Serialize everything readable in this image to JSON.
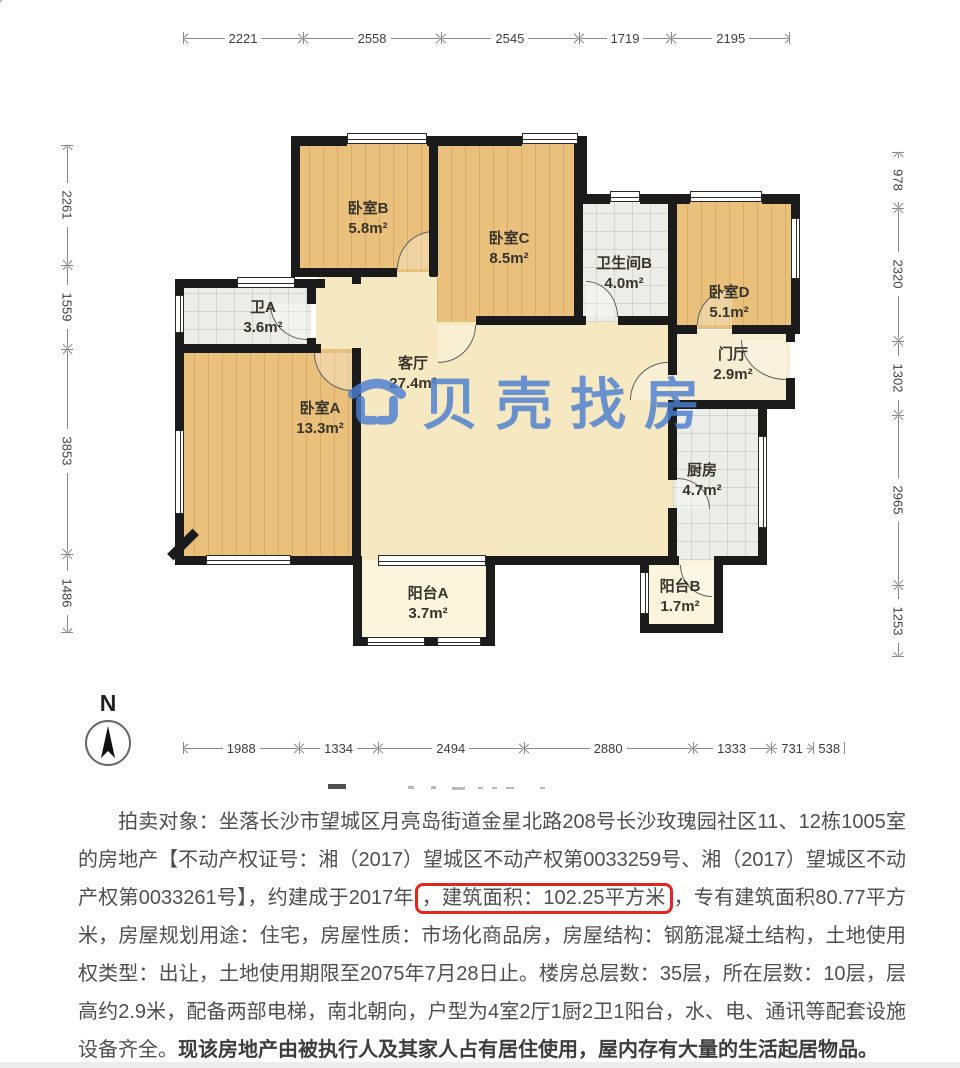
{
  "figure": {
    "watermark_text": "贝壳找房",
    "north_label": "N",
    "rooms": [
      {
        "id": "bedroomB",
        "name": "卧室B",
        "area": "5.8m²"
      },
      {
        "id": "bedroomC",
        "name": "卧室C",
        "area": "8.5m²"
      },
      {
        "id": "bathB",
        "name": "卫生间B",
        "area": "4.0m²"
      },
      {
        "id": "bedroomD",
        "name": "卧室D",
        "area": "5.1m²"
      },
      {
        "id": "bathA",
        "name": "卫A",
        "area": "3.6m²"
      },
      {
        "id": "living",
        "name": "客厅",
        "area": "27.4m²"
      },
      {
        "id": "hall",
        "name": "门厅",
        "area": "2.9m²"
      },
      {
        "id": "bedroomA",
        "name": "卧室A",
        "area": "13.3m²"
      },
      {
        "id": "kitchen",
        "name": "厨房",
        "area": "4.7m²"
      },
      {
        "id": "balconyA",
        "name": "阳台A",
        "area": "3.7m²"
      },
      {
        "id": "balconyB",
        "name": "阳台B",
        "area": "1.7m²"
      }
    ],
    "dimensions": {
      "top": [
        "2221",
        "2558",
        "2545",
        "1719",
        "2195"
      ],
      "left": [
        "2261",
        "1559",
        "3853",
        "1486"
      ],
      "right": [
        "978",
        "2320",
        "1302",
        "2965",
        "1253"
      ],
      "bottom": [
        "1988",
        "1334",
        "2494",
        "2880",
        "1333",
        "731",
        "538"
      ]
    },
    "accent_colors": {
      "watermark_blue": "#4a7ed0",
      "wall_black": "#1b1b1b",
      "highlight_red": "#e4261f"
    }
  },
  "description": {
    "part1": "拍卖对象：坐落长沙市望城区月亮岛街道金星北路208号长沙玫瑰园社区11、12栋1005室的房地产【不动产权证号：湘（2017）望城区不动产权第0033259号、湘（2017）望城区不动产权第0033261号】，约建成于2017年",
    "highlight": "，建筑面积：102.25平方米",
    "part2": "，专有建筑面积80.77平方米，房屋规划用途：住宅，房屋性质：市场化商品房，房屋结构：钢筋混凝土结构，土地使用权类型：出让，土地使用期限至2075年7月28日止。楼房总层数：35层，所在层数：10层，层高约2.9米，配备两部电梯，南北朝向，户型为4室2厅1厨2卫1阳台，水、电、通讯等配套设施设备齐全。",
    "bold_note": "现该房地产由被执行人及其家人占有居住使用，屋内存有大量的生活起居物品。"
  }
}
